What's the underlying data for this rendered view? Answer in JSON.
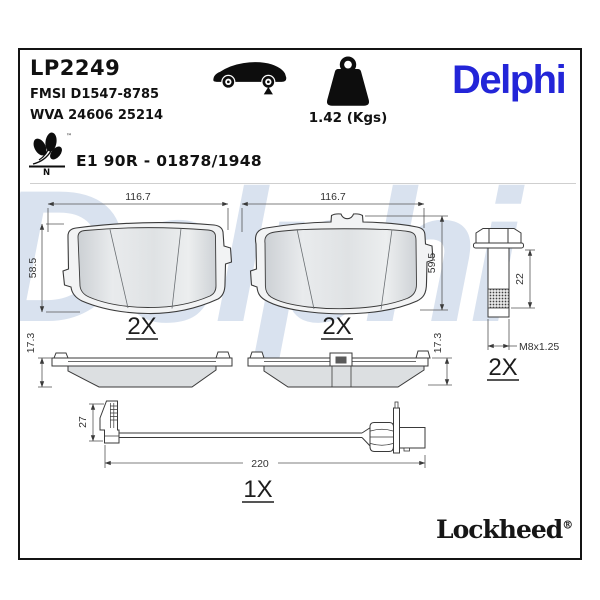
{
  "header": {
    "part_number": "LP2249",
    "fmsi_code": "FMSI D1547-8785",
    "wva_code": "WVA 24606 25214",
    "weight": "1.42 (Kgs)",
    "approval": "E1 90R - 01878/1948",
    "brand": "Delphi",
    "eco_letter": "N",
    "trademark_symbol": "™"
  },
  "watermark": "Delphi",
  "footer": {
    "brand": "Lockheed",
    "registered_symbol": "®"
  },
  "drawing": {
    "pad_back_left": {
      "width_mm": "116.7",
      "height_mm": "58.5",
      "qty": "2X"
    },
    "pad_back_right": {
      "width_mm": "116.7",
      "height_mm": "59.5",
      "qty": "2X"
    },
    "pad_side_left": {
      "thickness_mm": "17.3"
    },
    "pad_side_right": {
      "thickness_mm": "17.3"
    },
    "bolt": {
      "length_mm": "22",
      "thread": "M8x1.25",
      "qty": "2X"
    },
    "wear_sensor": {
      "clip_height_mm": "27",
      "length_mm": "220",
      "qty": "1X"
    }
  },
  "colors": {
    "brand_blue": "#2325d8",
    "watermark_blue": "#d9e2ef",
    "line_dark": "#3a3a3a"
  }
}
